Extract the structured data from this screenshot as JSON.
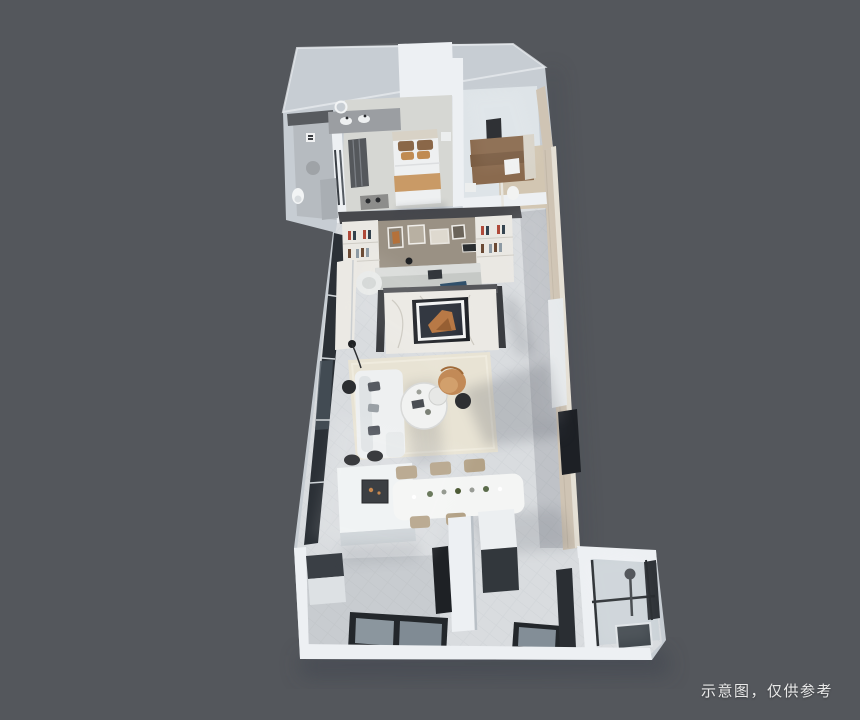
{
  "caption": {
    "text": "示意图，仅供参考"
  },
  "scene": {
    "type": "3d-dollhouse-floorplan-render",
    "view": "top-down axonometric",
    "objects": [
      "master-bedroom",
      "master-bathroom",
      "second-bedroom",
      "ensuite",
      "study-bookshelf-wall",
      "desk",
      "tv-partition-marble-wall",
      "living-room",
      "sofa",
      "coffee-table",
      "armchair",
      "rug",
      "floor-lamp",
      "kitchen-island",
      "bar-stools",
      "dining-table",
      "dining-chairs",
      "entry-hall",
      "wardrobe",
      "bottom-windows",
      "shower-bathroom",
      "balcony-glazing",
      "roof-planes"
    ]
  },
  "palette": {
    "bg": "#54575c",
    "roof": "#5f6266",
    "wallSide": "#c7cdd3",
    "wallTop": "#edf0f3",
    "beigeWall": "#cfc4b4",
    "beigeTop": "#e5e0d5",
    "floorMain": "#d9dcdf",
    "bedroomFloor": "#d6d7d3",
    "bedroom2Floor": "#dee4e8",
    "tile": "#b6bbc0",
    "glass": "#2b3036",
    "rug": "#e8e3d4",
    "sofa": "#eef0f1",
    "marble": "#ebe9e4",
    "frameDark": "#1d2025",
    "artOrange": "#b4713a",
    "shelfTaupe": "#9a9184",
    "shelfWhite": "#eae8e3",
    "beamDark": "#47484c",
    "chairTan": "#b3a287",
    "armchair": "#c28a57",
    "stoolDark": "#232528",
    "tableWhite": "#f4f5f4",
    "bedBrown": "#8a6a4e",
    "pillowTan": "#c08b52",
    "shadow": "#3a414b",
    "caption": "#e9e9e9"
  }
}
